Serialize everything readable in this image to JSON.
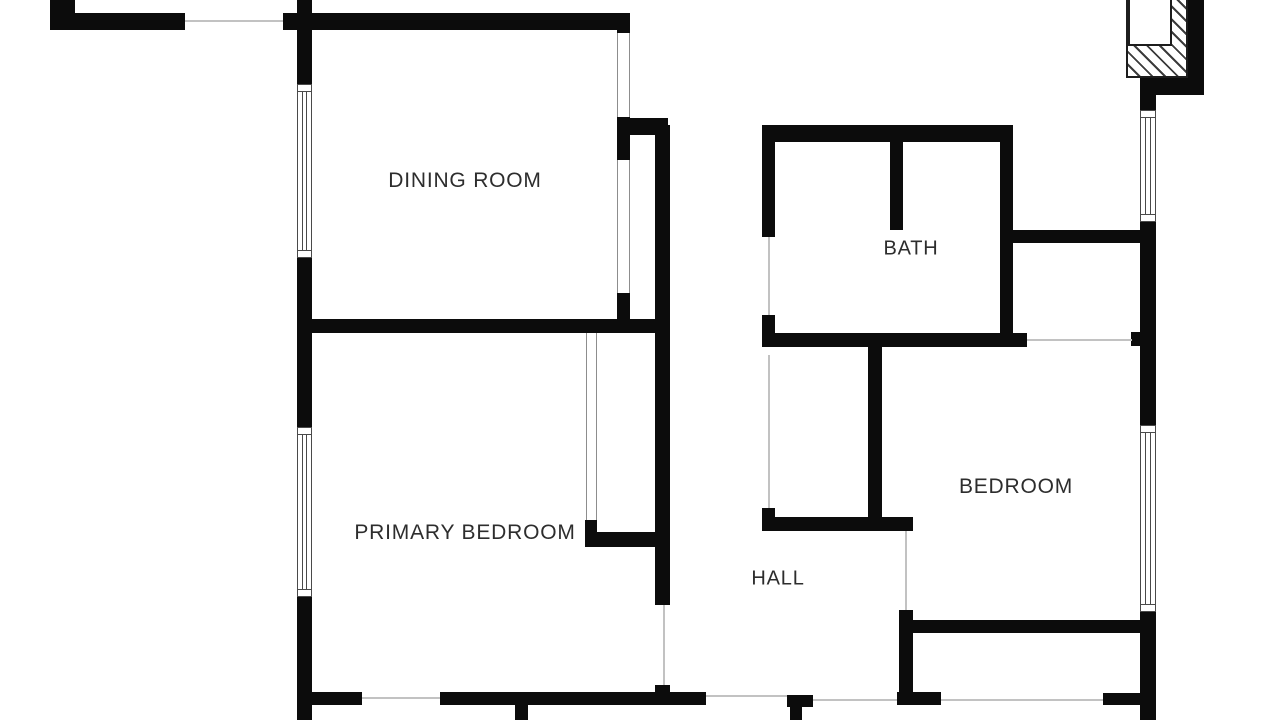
{
  "canvas": {
    "width": 1280,
    "height": 720,
    "background": "#ffffff"
  },
  "colors": {
    "wall": "#0c0c0c",
    "label_text": "#2d2d2d",
    "opening_line": "#8d8d8d",
    "faint_line": "#c2c2c2",
    "window_line": "#4a4a4a",
    "hatch_line": "#3c3c3c"
  },
  "plan": {
    "rooms": [
      {
        "id": "dining-room",
        "label": "DINING ROOM",
        "cx": 465,
        "cy": 181,
        "font_size": 21
      },
      {
        "id": "bath",
        "label": "BATH",
        "cx": 911,
        "cy": 249,
        "font_size": 20
      },
      {
        "id": "primary-bedroom",
        "label": "PRIMARY BEDROOM",
        "cx": 465,
        "cy": 533,
        "font_size": 21
      },
      {
        "id": "bedroom",
        "label": "BEDROOM",
        "cx": 1016,
        "cy": 487,
        "font_size": 21
      },
      {
        "id": "hall",
        "label": "HALL",
        "cx": 778,
        "cy": 579,
        "font_size": 20
      }
    ],
    "walls": [
      {
        "x": 50,
        "y": 0,
        "w": 25,
        "h": 30
      },
      {
        "x": 60,
        "y": 13,
        "w": 125,
        "h": 17
      },
      {
        "x": 297,
        "y": 0,
        "w": 15,
        "h": 85
      },
      {
        "x": 297,
        "y": 257,
        "w": 15,
        "h": 170
      },
      {
        "x": 297,
        "y": 597,
        "w": 15,
        "h": 123
      },
      {
        "x": 283,
        "y": 13,
        "w": 347,
        "h": 17
      },
      {
        "x": 617,
        "y": 13,
        "w": 13,
        "h": 20
      },
      {
        "x": 617,
        "y": 117,
        "w": 13,
        "h": 43
      },
      {
        "x": 617,
        "y": 293,
        "w": 13,
        "h": 27
      },
      {
        "x": 630,
        "y": 118,
        "w": 38,
        "h": 17
      },
      {
        "x": 655,
        "y": 125,
        "w": 15,
        "h": 480
      },
      {
        "x": 655,
        "y": 685,
        "w": 15,
        "h": 18
      },
      {
        "x": 297,
        "y": 319,
        "w": 373,
        "h": 14
      },
      {
        "x": 585,
        "y": 520,
        "w": 12,
        "h": 14
      },
      {
        "x": 585,
        "y": 532,
        "w": 85,
        "h": 15
      },
      {
        "x": 310,
        "y": 692,
        "w": 52,
        "h": 13
      },
      {
        "x": 440,
        "y": 692,
        "w": 266,
        "h": 13
      },
      {
        "x": 515,
        "y": 703,
        "w": 13,
        "h": 17
      },
      {
        "x": 787,
        "y": 695,
        "w": 26,
        "h": 12
      },
      {
        "x": 790,
        "y": 707,
        "w": 12,
        "h": 13
      },
      {
        "x": 762,
        "y": 125,
        "w": 250,
        "h": 17
      },
      {
        "x": 762,
        "y": 125,
        "w": 13,
        "h": 112
      },
      {
        "x": 762,
        "y": 315,
        "w": 13,
        "h": 32
      },
      {
        "x": 890,
        "y": 135,
        "w": 13,
        "h": 95
      },
      {
        "x": 1000,
        "y": 125,
        "w": 13,
        "h": 222
      },
      {
        "x": 762,
        "y": 333,
        "w": 265,
        "h": 14
      },
      {
        "x": 1012,
        "y": 230,
        "w": 128,
        "h": 13
      },
      {
        "x": 868,
        "y": 345,
        "w": 14,
        "h": 172
      },
      {
        "x": 762,
        "y": 508,
        "w": 13,
        "h": 12
      },
      {
        "x": 762,
        "y": 517,
        "w": 151,
        "h": 14
      },
      {
        "x": 899,
        "y": 610,
        "w": 14,
        "h": 95
      },
      {
        "x": 897,
        "y": 692,
        "w": 44,
        "h": 13
      },
      {
        "x": 899,
        "y": 620,
        "w": 256,
        "h": 13
      },
      {
        "x": 1103,
        "y": 693,
        "w": 39,
        "h": 12
      },
      {
        "x": 1140,
        "y": 95,
        "w": 16,
        "h": 15
      },
      {
        "x": 1140,
        "y": 222,
        "w": 16,
        "h": 203
      },
      {
        "x": 1140,
        "y": 612,
        "w": 16,
        "h": 108
      },
      {
        "x": 1188,
        "y": 0,
        "w": 16,
        "h": 95
      },
      {
        "x": 1140,
        "y": 77,
        "w": 64,
        "h": 18
      },
      {
        "x": 1131,
        "y": 332,
        "w": 9,
        "h": 14
      }
    ],
    "windows": [
      {
        "id": "window-dining-left",
        "x": 297,
        "y": 84,
        "w": 15,
        "h": 174
      },
      {
        "id": "window-primary-left",
        "x": 297,
        "y": 427,
        "w": 15,
        "h": 170
      },
      {
        "id": "window-right-upper",
        "x": 1140,
        "y": 110,
        "w": 16,
        "h": 112
      },
      {
        "id": "window-bedroom-right",
        "x": 1140,
        "y": 425,
        "w": 16,
        "h": 187
      }
    ],
    "openings": [
      {
        "id": "opening-dining-upper",
        "x": 617,
        "y": 33,
        "w": 13,
        "h": 84
      },
      {
        "id": "opening-dining-lower",
        "x": 617,
        "y": 160,
        "w": 13,
        "h": 133
      },
      {
        "id": "opening-closet-front",
        "x": 586,
        "y": 333,
        "w": 11,
        "h": 187
      }
    ],
    "faint_lines": [
      {
        "x": 185,
        "y": 20,
        "w": 98,
        "h": 2
      },
      {
        "x": 362,
        "y": 697,
        "w": 78,
        "h": 2
      },
      {
        "x": 706,
        "y": 695,
        "w": 81,
        "h": 2
      },
      {
        "x": 813,
        "y": 699,
        "w": 84,
        "h": 2
      },
      {
        "x": 941,
        "y": 699,
        "w": 162,
        "h": 2
      },
      {
        "x": 1027,
        "y": 339,
        "w": 105,
        "h": 2
      },
      {
        "x": 663,
        "y": 605,
        "w": 2,
        "h": 80
      },
      {
        "x": 768,
        "y": 237,
        "w": 2,
        "h": 78
      },
      {
        "x": 768,
        "y": 355,
        "w": 2,
        "h": 153
      },
      {
        "x": 905,
        "y": 531,
        "w": 2,
        "h": 79
      }
    ],
    "fireplace": {
      "hatch": {
        "x": 1126,
        "y": -2,
        "w": 62,
        "h": 80
      },
      "inset": {
        "x": 1128,
        "y": -2,
        "w": 44,
        "h": 48
      }
    }
  }
}
